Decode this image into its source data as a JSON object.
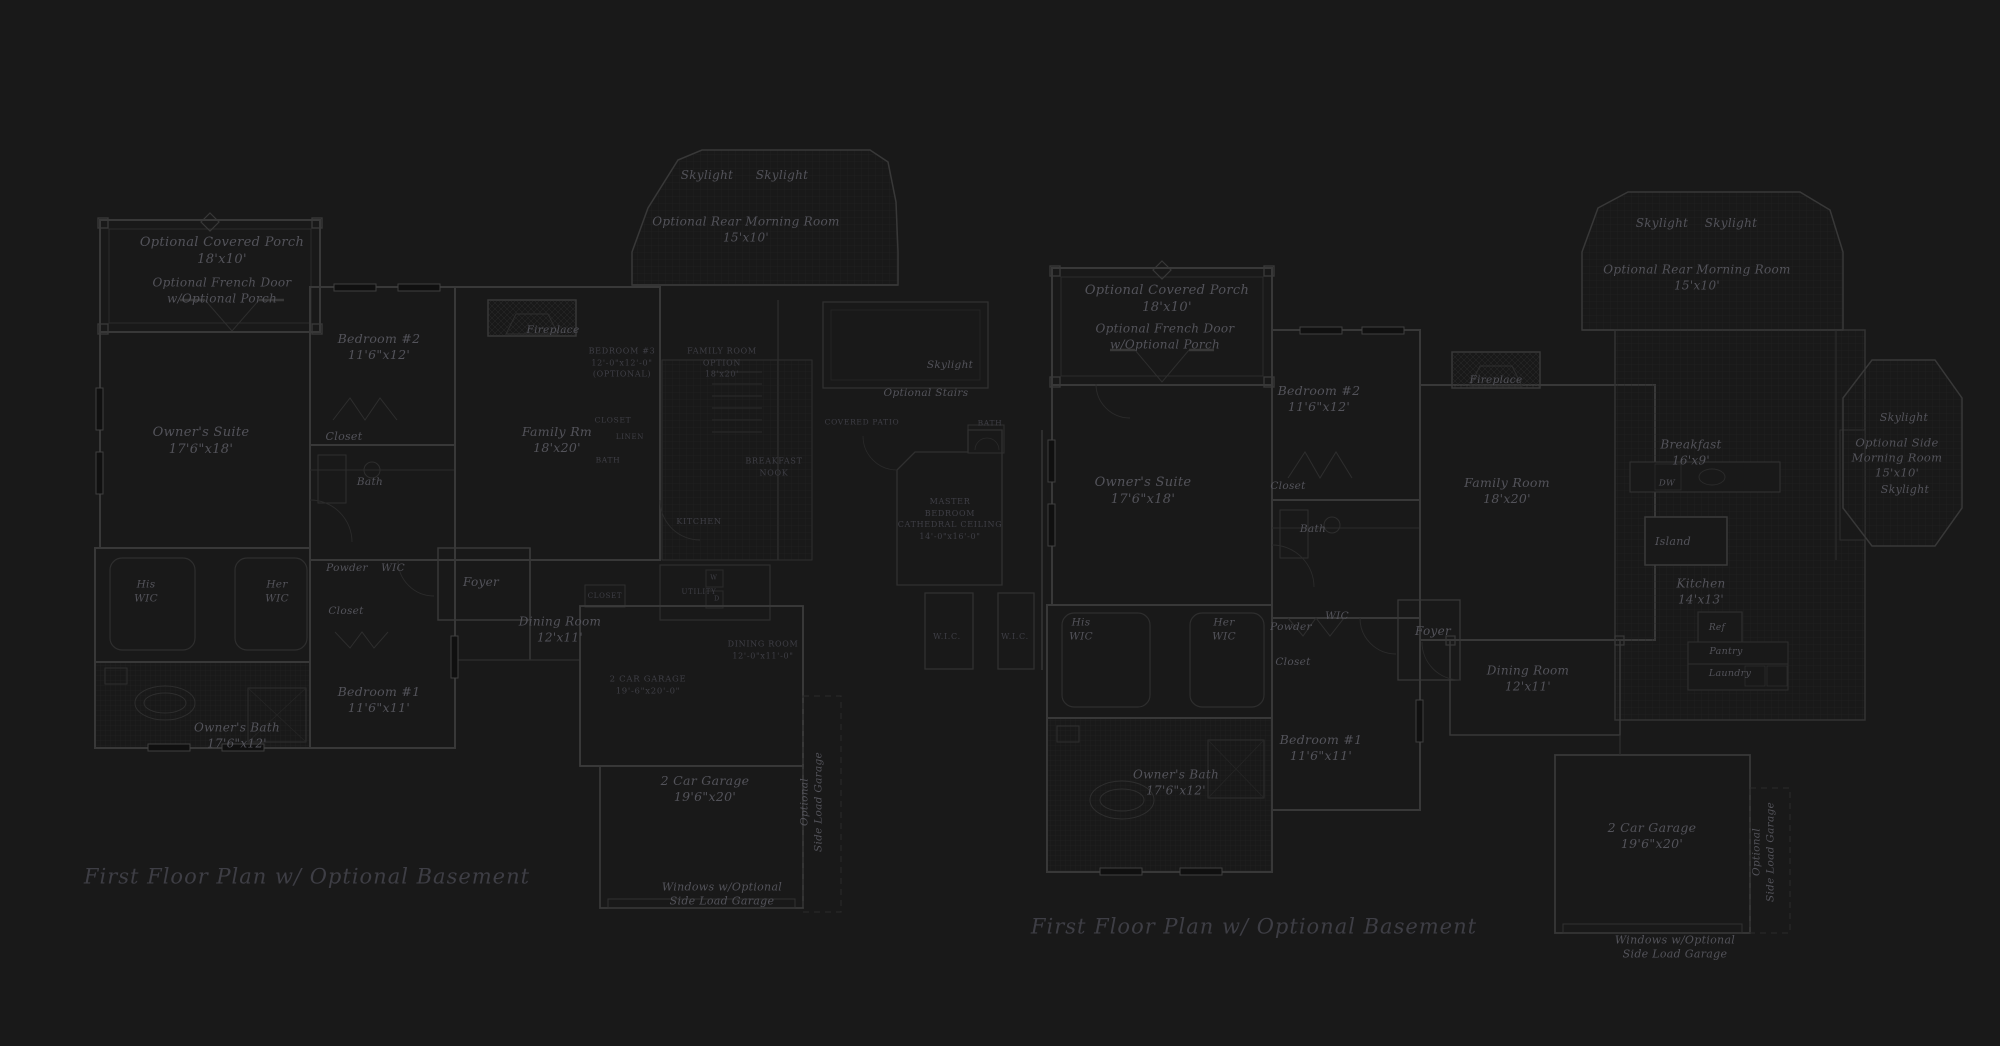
{
  "document": {
    "type": "architectural-floor-plan-sheet",
    "colors": {
      "background": "#191919",
      "wall_line": "#383838",
      "detail_line": "#2c2c2c",
      "grid_line": "#232323",
      "label_text": "#53535a",
      "caps_text": "#45454c",
      "title_text": "#3e3e45"
    }
  },
  "plans": [
    {
      "title": "First Floor Plan  w/ Optional Basement",
      "labels": [
        {
          "name": "label-optional-covered-porch",
          "text": "Optional Covered Porch\n18'x10'",
          "x": 222,
          "y": 252,
          "fs": 13,
          "cls": "lbl"
        },
        {
          "name": "label-optional-french-door",
          "text": "Optional French Door\nw/Optional Porch",
          "x": 222,
          "y": 291,
          "fs": 12,
          "cls": "lbl"
        },
        {
          "name": "label-bedroom-2",
          "text": "Bedroom #2\n11'6\"x12'",
          "x": 379,
          "y": 347,
          "fs": 12.5,
          "cls": "lbl"
        },
        {
          "name": "label-closet-bedroom-2",
          "text": "Closet",
          "x": 344,
          "y": 437,
          "fs": 11,
          "cls": "lbl"
        },
        {
          "name": "label-bath",
          "text": "Bath",
          "x": 370,
          "y": 483,
          "fs": 10.5,
          "cls": "lbl"
        },
        {
          "name": "label-owners-suite",
          "text": "Owner's Suite\n17'6\"x18'",
          "x": 201,
          "y": 442,
          "fs": 13,
          "cls": "lbl"
        },
        {
          "name": "label-his-wic",
          "text": "His\nWIC",
          "x": 146,
          "y": 592,
          "fs": 10.5,
          "cls": "lbl"
        },
        {
          "name": "label-her-wic",
          "text": "Her\nWIC",
          "x": 277,
          "y": 592,
          "fs": 10.5,
          "cls": "lbl"
        },
        {
          "name": "label-powder",
          "text": "Powder",
          "x": 347,
          "y": 569,
          "fs": 10.5,
          "cls": "lbl"
        },
        {
          "name": "label-wic",
          "text": "WIC",
          "x": 393,
          "y": 569,
          "fs": 10.5,
          "cls": "lbl"
        },
        {
          "name": "label-closet-hall",
          "text": "Closet",
          "x": 346,
          "y": 612,
          "fs": 10.5,
          "cls": "lbl"
        },
        {
          "name": "label-bedroom-1",
          "text": "Bedroom #1\n11'6\"x11'",
          "x": 379,
          "y": 700,
          "fs": 12.5,
          "cls": "lbl"
        },
        {
          "name": "label-owners-bath",
          "text": "Owner's Bath\n17'6\"x12'",
          "x": 237,
          "y": 736,
          "fs": 12,
          "cls": "lbl"
        },
        {
          "name": "label-fireplace",
          "text": "Fireplace",
          "x": 553,
          "y": 331,
          "fs": 10.5,
          "cls": "lbl"
        },
        {
          "name": "label-skylight-1",
          "text": "Skylight",
          "x": 707,
          "y": 176,
          "fs": 12,
          "cls": "lbl"
        },
        {
          "name": "label-skylight-2",
          "text": "Skylight",
          "x": 782,
          "y": 176,
          "fs": 12,
          "cls": "lbl"
        },
        {
          "name": "label-optional-rear-morning-room",
          "text": "Optional Rear Morning Room\n15'x10'",
          "x": 746,
          "y": 230,
          "fs": 12,
          "cls": "lbl"
        },
        {
          "name": "label-family-rm",
          "text": "Family Rm\n18'x20'",
          "x": 557,
          "y": 440,
          "fs": 12.5,
          "cls": "lbl"
        },
        {
          "name": "label-bedroom-3-option",
          "text": "BEDROOM #3\n12'-0\"x12'-0\"\n(OPTIONAL)",
          "x": 622,
          "y": 363,
          "fs": 8,
          "cls": "caps dim"
        },
        {
          "name": "label-family-room-option",
          "text": "FAMILY ROOM\nOPTION\n18'x20'",
          "x": 722,
          "y": 363,
          "fs": 8,
          "cls": "caps dim"
        },
        {
          "name": "label-closet-option",
          "text": "CLOSET",
          "x": 613,
          "y": 421,
          "fs": 7.5,
          "cls": "caps dim"
        },
        {
          "name": "label-linen",
          "text": "LINEN",
          "x": 630,
          "y": 437,
          "fs": 7,
          "cls": "caps dim"
        },
        {
          "name": "label-bath-option",
          "text": "BATH",
          "x": 608,
          "y": 461,
          "fs": 7.5,
          "cls": "caps dim"
        },
        {
          "name": "label-kitchen-caps",
          "text": "KITCHEN",
          "x": 699,
          "y": 522,
          "fs": 8,
          "cls": "caps dim"
        },
        {
          "name": "label-breakfast-nook",
          "text": "BREAKFAST\nNOOK",
          "x": 774,
          "y": 467,
          "fs": 8,
          "cls": "caps dim"
        },
        {
          "name": "label-optional-stairs",
          "text": "Optional Stairs",
          "x": 926,
          "y": 394,
          "fs": 10.5,
          "cls": "lbl"
        },
        {
          "name": "label-skylight-center",
          "text": "Skylight",
          "x": 950,
          "y": 366,
          "fs": 10.5,
          "cls": "lbl"
        },
        {
          "name": "label-covered-patio",
          "text": "COVERED PATIO",
          "x": 862,
          "y": 423,
          "fs": 7.5,
          "cls": "caps dim"
        },
        {
          "name": "label-master-bath-option",
          "text": "BATH",
          "x": 990,
          "y": 424,
          "fs": 7.5,
          "cls": "caps dim"
        },
        {
          "name": "label-master-bedroom-option",
          "text": "MASTER\nBEDROOM\nCATHEDRAL CEILING\n14'-0\"x16'-0\"",
          "x": 950,
          "y": 519,
          "fs": 8,
          "cls": "caps dim"
        },
        {
          "name": "label-wic-option-1",
          "text": "W.I.C.",
          "x": 947,
          "y": 637,
          "fs": 8,
          "cls": "caps dim"
        },
        {
          "name": "label-wic-option-2",
          "text": "W.I.C.",
          "x": 1015,
          "y": 637,
          "fs": 8,
          "cls": "caps dim"
        },
        {
          "name": "label-foyer",
          "text": "Foyer",
          "x": 481,
          "y": 583,
          "fs": 12,
          "cls": "lbl"
        },
        {
          "name": "label-dining-room",
          "text": "Dining Room\n12'x11'",
          "x": 560,
          "y": 630,
          "fs": 12,
          "cls": "lbl"
        },
        {
          "name": "label-closet-foyer",
          "text": "CLOSET",
          "x": 605,
          "y": 596,
          "fs": 7,
          "cls": "caps dim"
        },
        {
          "name": "label-utility",
          "text": "UTILITY",
          "x": 699,
          "y": 592,
          "fs": 7,
          "cls": "caps dim"
        },
        {
          "name": "label-washer",
          "text": "W",
          "x": 714,
          "y": 578,
          "fs": 6.5,
          "cls": "caps dim"
        },
        {
          "name": "label-dryer",
          "text": "D",
          "x": 717,
          "y": 599,
          "fs": 6.5,
          "cls": "caps dim"
        },
        {
          "name": "label-garage-option",
          "text": "2 CAR GARAGE\n19'-6\"x20'-0\"",
          "x": 648,
          "y": 686,
          "fs": 8.5,
          "cls": "caps dim"
        },
        {
          "name": "label-dining-room-option",
          "text": "DINING ROOM\n12'-0\"x11'-0\"",
          "x": 763,
          "y": 650,
          "fs": 8,
          "cls": "caps dim"
        },
        {
          "name": "label-2-car-garage",
          "text": "2 Car Garage\n19'6\"x20'",
          "x": 705,
          "y": 789,
          "fs": 12.5,
          "cls": "lbl"
        },
        {
          "name": "label-optional-side-load-garage",
          "text": "Optional\nSide Load Garage",
          "x": 812,
          "y": 802,
          "fs": 10.5,
          "cls": "lbl",
          "rotate": -90
        },
        {
          "name": "label-windows-optional",
          "text": "Windows w/Optional\nSide Load Garage",
          "x": 722,
          "y": 895,
          "fs": 11,
          "cls": "lbl"
        }
      ]
    },
    {
      "title": "First Floor Plan  w/ Optional Basement",
      "labels": [
        {
          "name": "label-optional-covered-porch",
          "text": "Optional Covered Porch\n18'x10'",
          "x": 1167,
          "y": 300,
          "fs": 13,
          "cls": "lbl"
        },
        {
          "name": "label-optional-french-door",
          "text": "Optional French Door\nw/Optional Porch",
          "x": 1165,
          "y": 337,
          "fs": 12,
          "cls": "lbl"
        },
        {
          "name": "label-bedroom-2",
          "text": "Bedroom #2\n11'6\"x12'",
          "x": 1319,
          "y": 399,
          "fs": 12.5,
          "cls": "lbl"
        },
        {
          "name": "label-closet-bedroom-2",
          "text": "Closet",
          "x": 1288,
          "y": 487,
          "fs": 10.5,
          "cls": "lbl"
        },
        {
          "name": "label-bath",
          "text": "Bath",
          "x": 1313,
          "y": 530,
          "fs": 10.5,
          "cls": "lbl"
        },
        {
          "name": "label-owners-suite",
          "text": "Owner's Suite\n17'6\"x18'",
          "x": 1143,
          "y": 492,
          "fs": 13,
          "cls": "lbl"
        },
        {
          "name": "label-his-wic",
          "text": "His\nWIC",
          "x": 1081,
          "y": 630,
          "fs": 10.5,
          "cls": "lbl"
        },
        {
          "name": "label-her-wic",
          "text": "Her\nWIC",
          "x": 1224,
          "y": 630,
          "fs": 10.5,
          "cls": "lbl"
        },
        {
          "name": "label-powder",
          "text": "Powder",
          "x": 1291,
          "y": 628,
          "fs": 10.5,
          "cls": "lbl"
        },
        {
          "name": "label-wic",
          "text": "WIC",
          "x": 1337,
          "y": 617,
          "fs": 10.5,
          "cls": "lbl"
        },
        {
          "name": "label-closet-hall",
          "text": "Closet",
          "x": 1293,
          "y": 663,
          "fs": 10.5,
          "cls": "lbl"
        },
        {
          "name": "label-bedroom-1",
          "text": "Bedroom #1\n11'6\"x11'",
          "x": 1321,
          "y": 748,
          "fs": 12.5,
          "cls": "lbl"
        },
        {
          "name": "label-owners-bath",
          "text": "Owner's Bath\n17'6\"x12'",
          "x": 1176,
          "y": 783,
          "fs": 12,
          "cls": "lbl"
        },
        {
          "name": "label-fireplace",
          "text": "Fireplace",
          "x": 1496,
          "y": 381,
          "fs": 10.5,
          "cls": "lbl"
        },
        {
          "name": "label-skylight-1",
          "text": "Skylight",
          "x": 1662,
          "y": 224,
          "fs": 12,
          "cls": "lbl"
        },
        {
          "name": "label-skylight-2",
          "text": "Skylight",
          "x": 1731,
          "y": 224,
          "fs": 12,
          "cls": "lbl"
        },
        {
          "name": "label-optional-rear-morning-room",
          "text": "Optional Rear Morning Room\n15'x10'",
          "x": 1697,
          "y": 278,
          "fs": 12,
          "cls": "lbl"
        },
        {
          "name": "label-family-room",
          "text": "Family Room\n18'x20'",
          "x": 1507,
          "y": 491,
          "fs": 12.5,
          "cls": "lbl"
        },
        {
          "name": "label-breakfast",
          "text": "Breakfast\n16'x9'",
          "x": 1691,
          "y": 453,
          "fs": 12,
          "cls": "lbl"
        },
        {
          "name": "label-dw",
          "text": "DW",
          "x": 1667,
          "y": 484,
          "fs": 8.5,
          "cls": "lbl"
        },
        {
          "name": "label-island",
          "text": "Island",
          "x": 1673,
          "y": 542,
          "fs": 11,
          "cls": "lbl"
        },
        {
          "name": "label-kitchen",
          "text": "Kitchen\n14'x13'",
          "x": 1701,
          "y": 592,
          "fs": 12,
          "cls": "lbl"
        },
        {
          "name": "label-ref",
          "text": "Ref",
          "x": 1717,
          "y": 629,
          "fs": 9,
          "cls": "lbl"
        },
        {
          "name": "label-pantry",
          "text": "Pantry",
          "x": 1726,
          "y": 652,
          "fs": 9.5,
          "cls": "lbl"
        },
        {
          "name": "label-laundry",
          "text": "Laundry",
          "x": 1730,
          "y": 674,
          "fs": 9.5,
          "cls": "lbl"
        },
        {
          "name": "label-dining-room",
          "text": "Dining Room\n12'x11'",
          "x": 1528,
          "y": 679,
          "fs": 12,
          "cls": "lbl"
        },
        {
          "name": "label-foyer",
          "text": "Foyer",
          "x": 1433,
          "y": 632,
          "fs": 12,
          "cls": "lbl"
        },
        {
          "name": "label-2-car-garage",
          "text": "2 Car Garage\n19'6\"x20'",
          "x": 1652,
          "y": 836,
          "fs": 12.5,
          "cls": "lbl"
        },
        {
          "name": "label-optional-side-load-garage",
          "text": "Optional\nSide Load Garage",
          "x": 1764,
          "y": 852,
          "fs": 10.5,
          "cls": "lbl",
          "rotate": -90
        },
        {
          "name": "label-windows-optional",
          "text": "Windows w/Optional\nSide Load Garage",
          "x": 1675,
          "y": 948,
          "fs": 11,
          "cls": "lbl"
        },
        {
          "name": "label-skylight-side-1",
          "text": "Skylight",
          "x": 1904,
          "y": 418,
          "fs": 11,
          "cls": "lbl"
        },
        {
          "name": "label-optional-side-morning-room",
          "text": "Optional Side\nMorning Room\n15'x10'",
          "x": 1897,
          "y": 458,
          "fs": 11.5,
          "cls": "lbl"
        },
        {
          "name": "label-skylight-side-2",
          "text": "Skylight",
          "x": 1905,
          "y": 490,
          "fs": 11,
          "cls": "lbl"
        }
      ]
    }
  ]
}
